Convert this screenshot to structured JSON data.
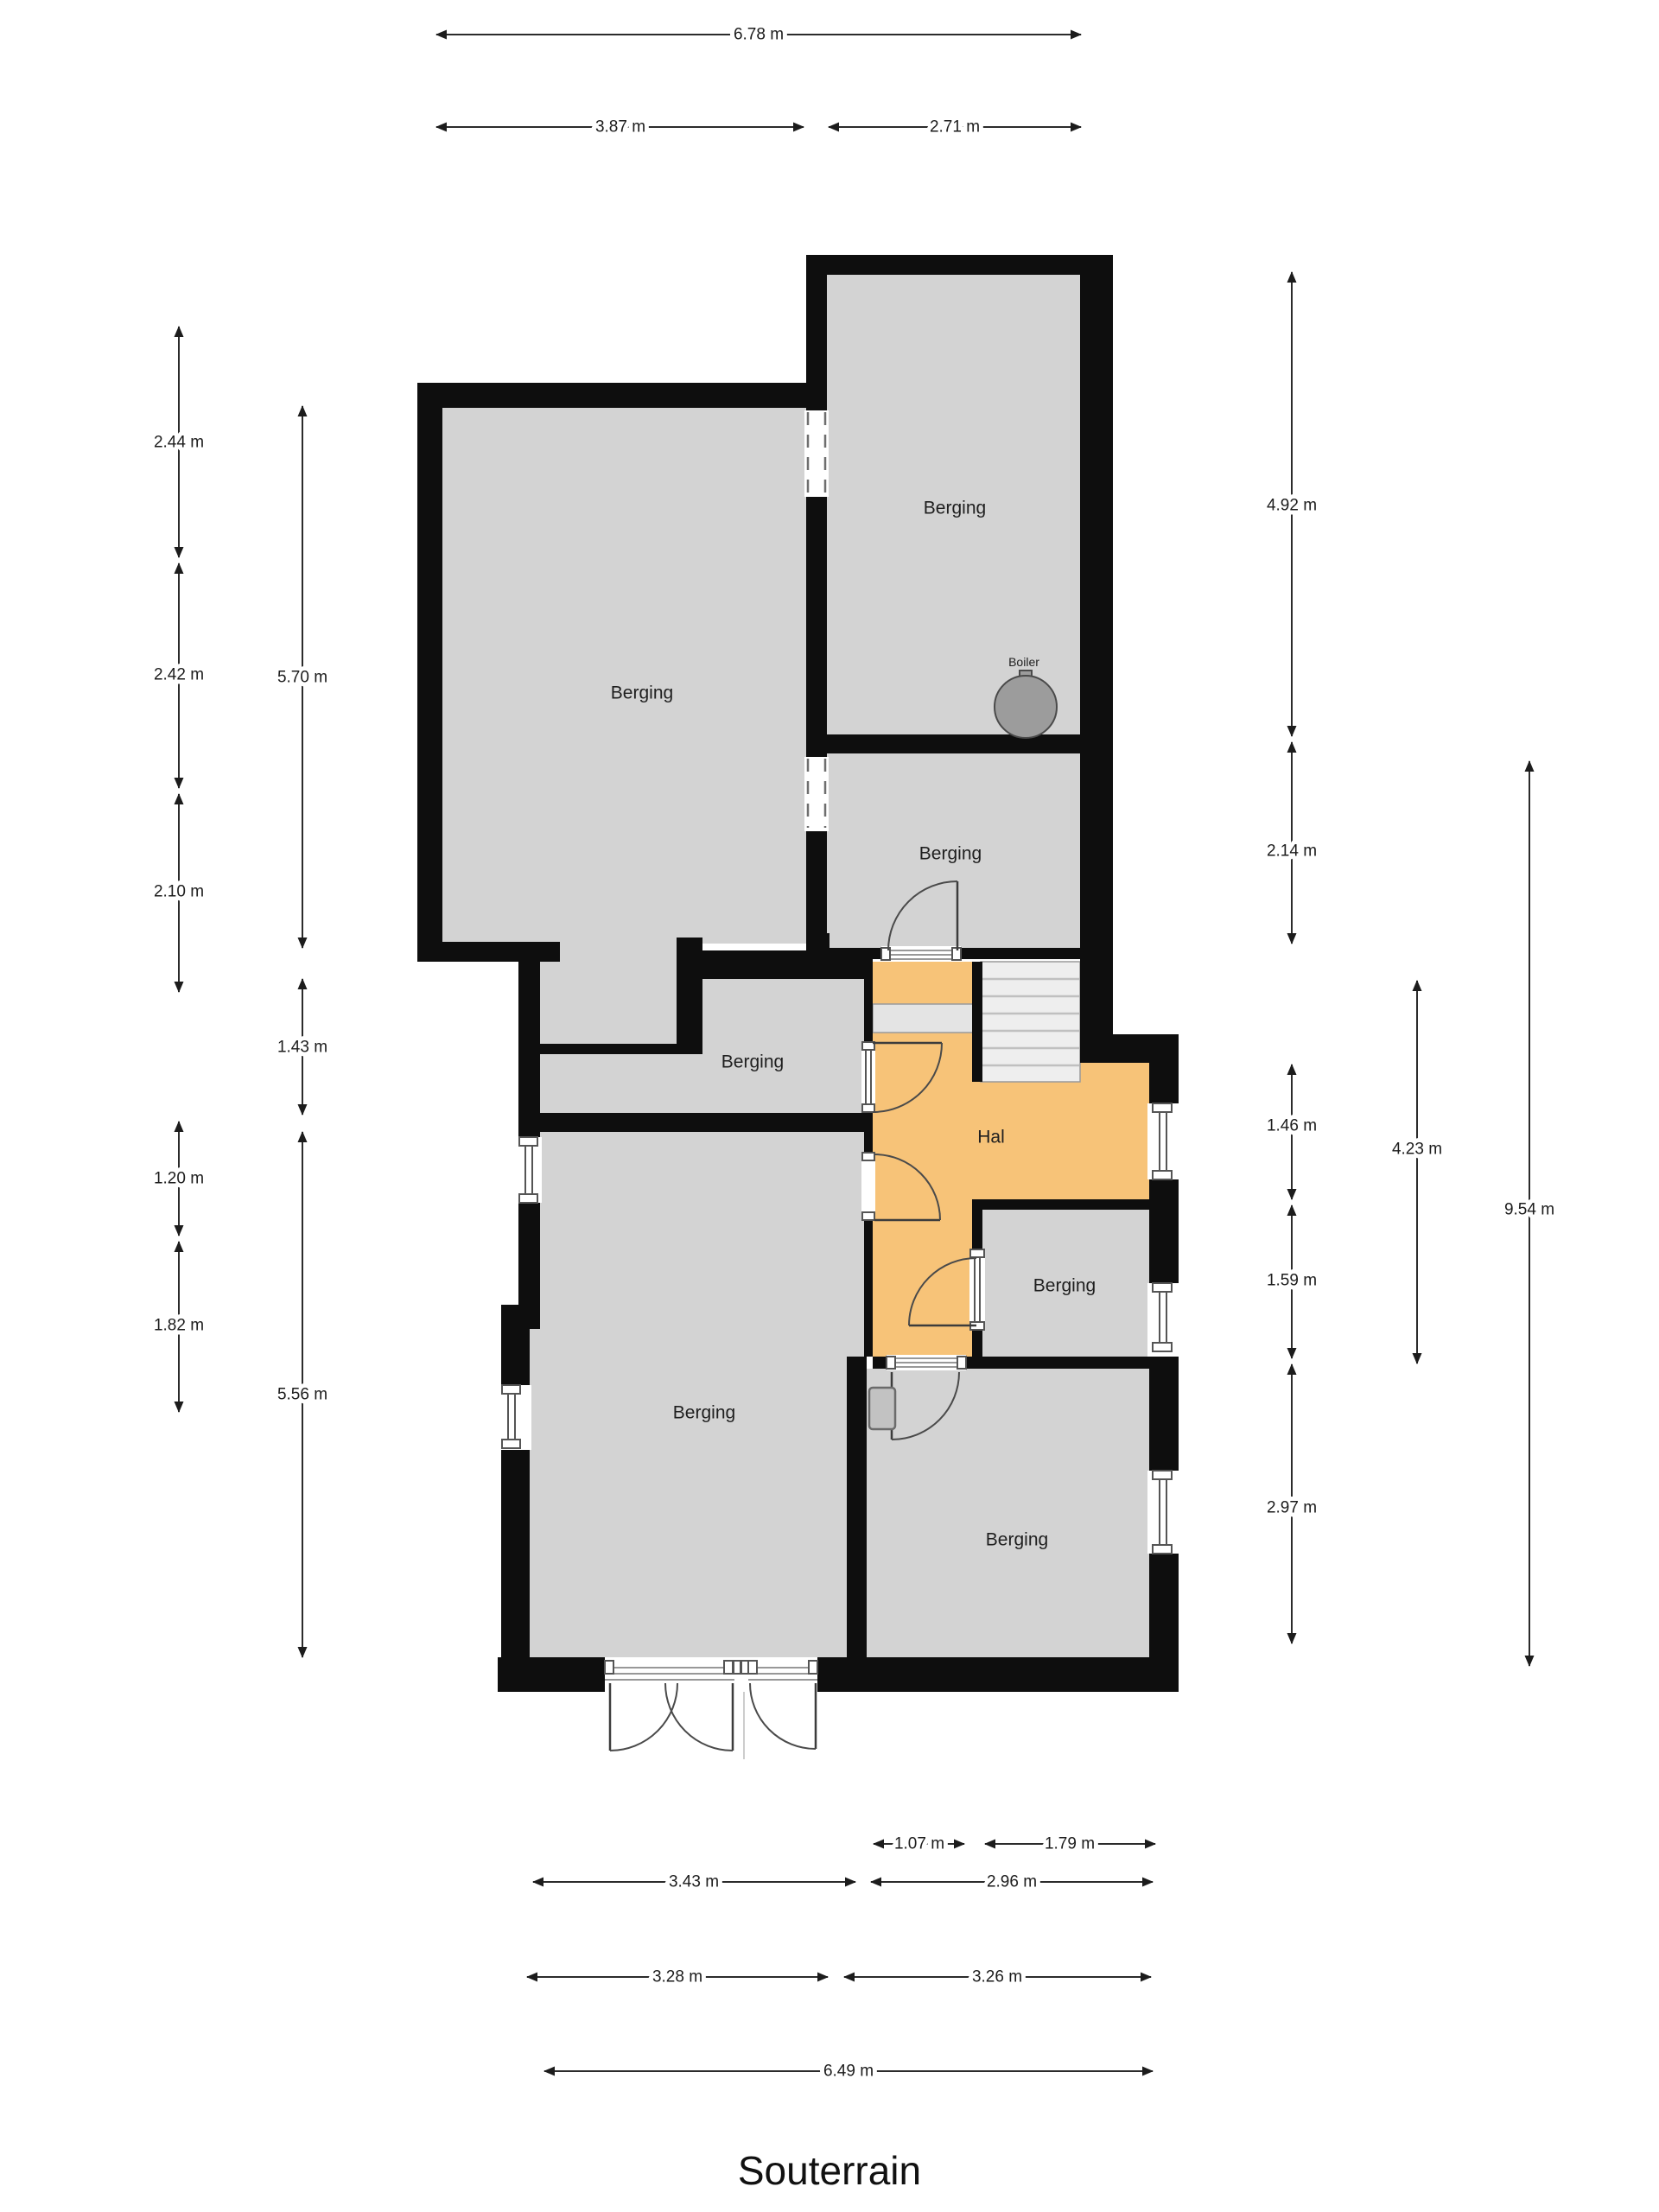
{
  "title": "Souterrain",
  "rooms": {
    "top_left": "Berging",
    "top_right": "Berging",
    "mid_right": "Berging",
    "mid_left": "Berging",
    "hal": "Hal",
    "bottom_left": "Berging",
    "right_small": "Berging",
    "bottom_right": "Berging"
  },
  "fixtures": {
    "boiler": "Boiler"
  },
  "dims": {
    "top_total": "6.78 m",
    "top_left": "3.87 m",
    "top_right": "2.71 m",
    "left_seg1": "2.44 m",
    "left_seg2": "2.42 m",
    "left_seg3": "2.10 m",
    "left_room_top": "5.70 m",
    "left_mid": "1.43 m",
    "left_seg4": "1.20 m",
    "left_seg5": "1.82 m",
    "left_room_bottom": "5.56 m",
    "right_top": "4.92 m",
    "right_mid": "2.14 m",
    "right_hal": "1.46 m",
    "right_berging": "1.59 m",
    "right_bottom": "2.97 m",
    "right_hal_total": "4.23 m",
    "right_total": "9.54 m",
    "bottom_door1": "1.07 m",
    "bottom_door2": "1.79 m",
    "bottom_row2_left": "3.43 m",
    "bottom_row2_right": "2.96 m",
    "bottom_row3_left": "3.28 m",
    "bottom_row3_right": "3.26 m",
    "bottom_total": "6.49 m"
  },
  "colors": {
    "wall": "#0e0e0e",
    "room_fill": "#d3d3d3",
    "hal_fill": "#f7c378",
    "landing_fill": "#e4e4e4",
    "stair_fill": "#eeeeee",
    "boiler_fill": "#9c9c9c"
  }
}
